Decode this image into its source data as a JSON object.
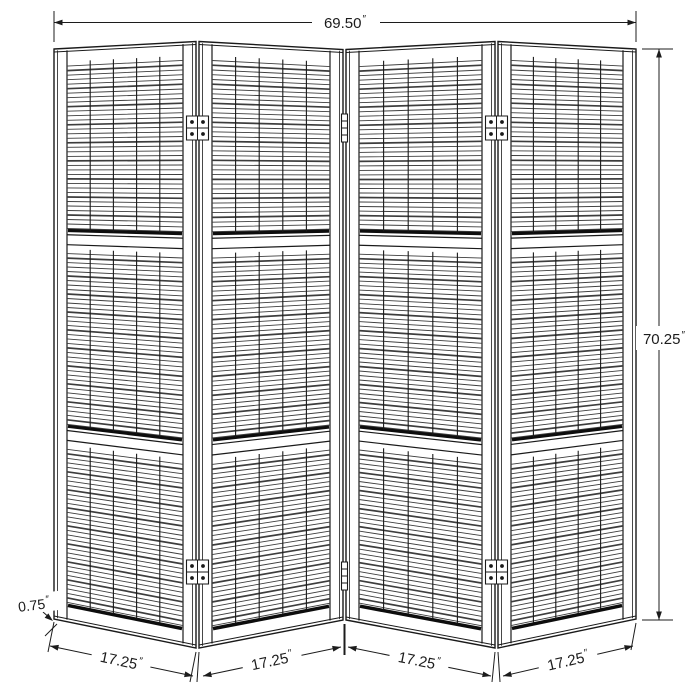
{
  "drawing": {
    "title": "Four-panel folding room divider — dimension drawing",
    "units_symbol": "″",
    "dimensions": {
      "overall_width": "69.50",
      "overall_height": "70.25",
      "panel_thickness": "0.75",
      "panel_widths": [
        "17.25",
        "17.25",
        "17.25",
        "17.25"
      ]
    },
    "panel_count": 4,
    "sections_per_panel": 3,
    "hinge_count": 6,
    "colors": {
      "background": "#ffffff",
      "frame_line": "#1a1a1a",
      "slat_line": "#3d3d3d",
      "shadow_line": "#0d0d0d",
      "dim_line": "#1c1c1c"
    }
  }
}
